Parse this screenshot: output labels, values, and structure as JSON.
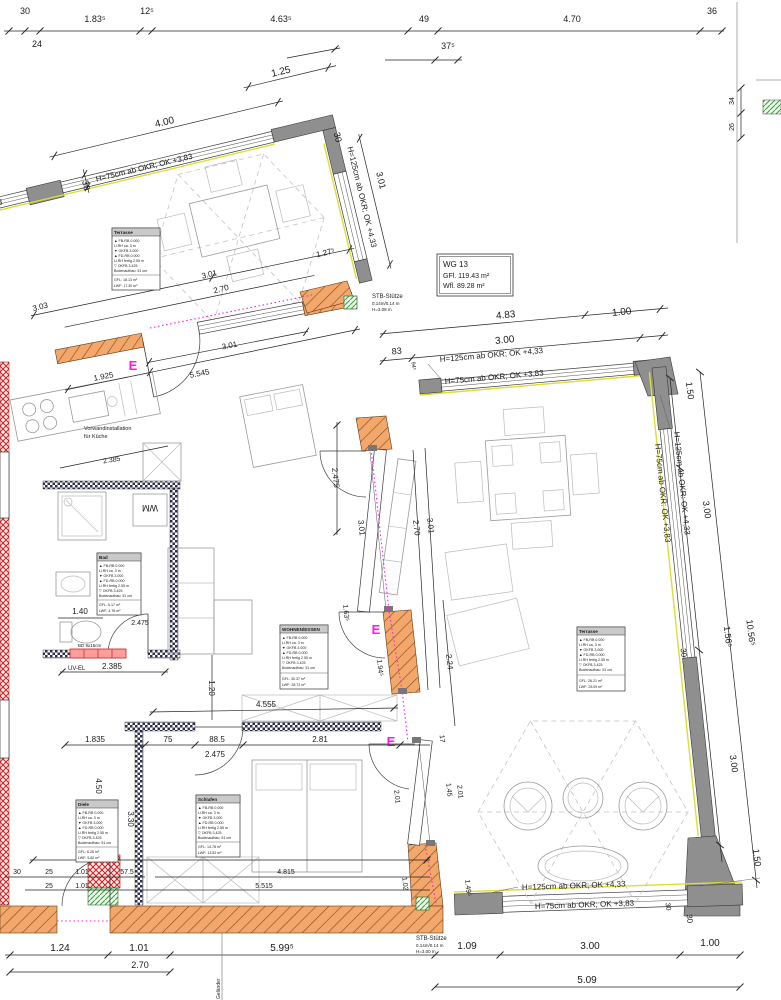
{
  "colors": {
    "wall_gray": "#8f8f8f",
    "hatch_orange": "#f3a76b",
    "hatch_orange_line": "#7c4a1d",
    "hatch_red": "#cc1f1f",
    "hatch_green": "#39a039",
    "window_yellow": "#dede30",
    "magenta": "#ff17e8"
  },
  "unit_box": {
    "title": "WG 13",
    "gfl": "GFl.   119.43 m²",
    "wfl": "Wfl.   89.28 m²"
  },
  "window_labels": {
    "h125": "H=125cm ab OKR; OK +4,33",
    "h75": "H=75cm ab OKR; OK +3,83",
    "h125_colon": "H=125cm ab OKR: OK +4,33",
    "h75_colon": "H=75cm ab OKR: OK +3,83"
  },
  "annotations": {
    "stb": "STB-Stütze",
    "stb_size": "0.14m/0.14 m",
    "stb_h": "H=3.08 m",
    "stb_h2": "H=3.00 m",
    "gelaender": "Geländer",
    "wm": "WM",
    "uv_el": "UV-EL",
    "bd": "BD 9x15cm",
    "vorwand1": "Vorwandinstallation",
    "vorwand2": "für Küche",
    "entrance": "E"
  },
  "dims": {
    "top": [
      "30",
      "24",
      "1.83⁵",
      "12⁵",
      "4.63⁵",
      "49",
      "37⁵",
      "4.70",
      "36"
    ],
    "sheet": [
      "34",
      "26"
    ],
    "terrace1": [
      "4.00",
      "1.25",
      "30",
      "30",
      "3.01",
      "3.01",
      "2.70",
      "3.03",
      "1.27⁵"
    ],
    "room2_north": [
      "4.83",
      "3.00",
      "1.00",
      "83",
      "94⁵"
    ],
    "room2_east": [
      "1.50",
      "3.00",
      "30",
      "3.00",
      "1.50",
      "30",
      "10.56⁵",
      "1.56⁵"
    ],
    "room2_south": [
      "1.09",
      "3.00",
      "1.00",
      "5.09",
      "30",
      "1.49⁵"
    ],
    "interior": [
      "2.475",
      "3.01",
      "1.63⁵",
      "1.94⁵",
      "2.70",
      "3.01",
      "2.24",
      "17",
      "2.01",
      "1.45",
      "2.01",
      "1.02"
    ],
    "center": [
      "3.01",
      "5.545",
      "1.925",
      "2.385",
      "2.385",
      "1.40",
      "2.475",
      "1.20"
    ],
    "bedroom": [
      "1.835",
      "75",
      "88.5",
      "2.81",
      "2.475",
      "4.555",
      "6.775",
      "4.815",
      "5.515",
      "57.5",
      "30",
      "25",
      "1.01",
      "25",
      "1.01",
      "4.50",
      "3.30"
    ],
    "bottom": [
      "1.24",
      "1.01",
      "2.70",
      "5.99⁵"
    ]
  },
  "room_boxes": [
    {
      "title": "Terrasse",
      "lines": [
        "▲ FB-RB 0.000",
        "Li.RH ca. 3 m",
        "▼ OKFB 3.000",
        "▲ FD-RB 0.000",
        "Li.RH fertig 2.55 m",
        "▽ OKFB 3.425",
        "Bodenaufbau: 51 cm",
        "GFL: 18.13 m²",
        "LWF: 17.30 m²"
      ]
    },
    {
      "title": "WOHNEN/ESSEN",
      "lines": [
        "▲ FB-RB 0.000",
        "Li.RH ca. 3 m",
        "▼ OKFB 3.000",
        "▲ FD-RB 0.000",
        "Li.RH fertig 2.55 m",
        "▽ OKFB 3.425",
        "Bodenaufbau: 51 cm",
        "GFL: 30.37 m²",
        "LWF: 28.72 m²"
      ]
    },
    {
      "title": "Terrasse",
      "lines": [
        "▲ FB-RB 0.000",
        "Li.RH ca. 3 m",
        "▼ OKFB 3.000",
        "▲ FD-RB 0.000",
        "Li.RH fertig 2.55 m",
        "▽ OKFB 3.425",
        "Bodenaufbau: 51 cm",
        "GFL: 26.21 m²",
        "LWF: 25.09 m²"
      ]
    },
    {
      "title": "Bad",
      "lines": [
        "▲ FB-RB 0.000",
        "Li.RH ca. 3 m",
        "▼ OKFB 3.000",
        "▲ FD-RB 0.000",
        "Li.RH fertig 2.55 m",
        "▽ OKFB 3.425",
        "Bodenaufbau: 51 cm",
        "GFL: 5.17 m²",
        "LWF: 4.76 m²"
      ]
    },
    {
      "title": "Diele",
      "lines": [
        "▲ FB-RB 0.000",
        "Li.RH ca. 3 m",
        "▼ OKFB 3.000",
        "▲ FD-RB 0.000",
        "Li.RH fertig 2.55 m",
        "▽ OKFB 3.425",
        "Bodenaufbau: 51 cm",
        "GFL: 6.26 m²",
        "LWF: 5.82 m²"
      ]
    },
    {
      "title": "Schlafen",
      "lines": [
        "▲ FB-RB 0.000",
        "Li.RH ca. 3 m",
        "▼ OKFB 3.000",
        "▲ FD-RB 0.000",
        "Li.RH fertig 2.55 m",
        "▽ OKFB 3.425",
        "Bodenaufbau: 51 cm",
        "GFL: 14.78 m²",
        "LWF: 13.52 m²"
      ]
    }
  ]
}
